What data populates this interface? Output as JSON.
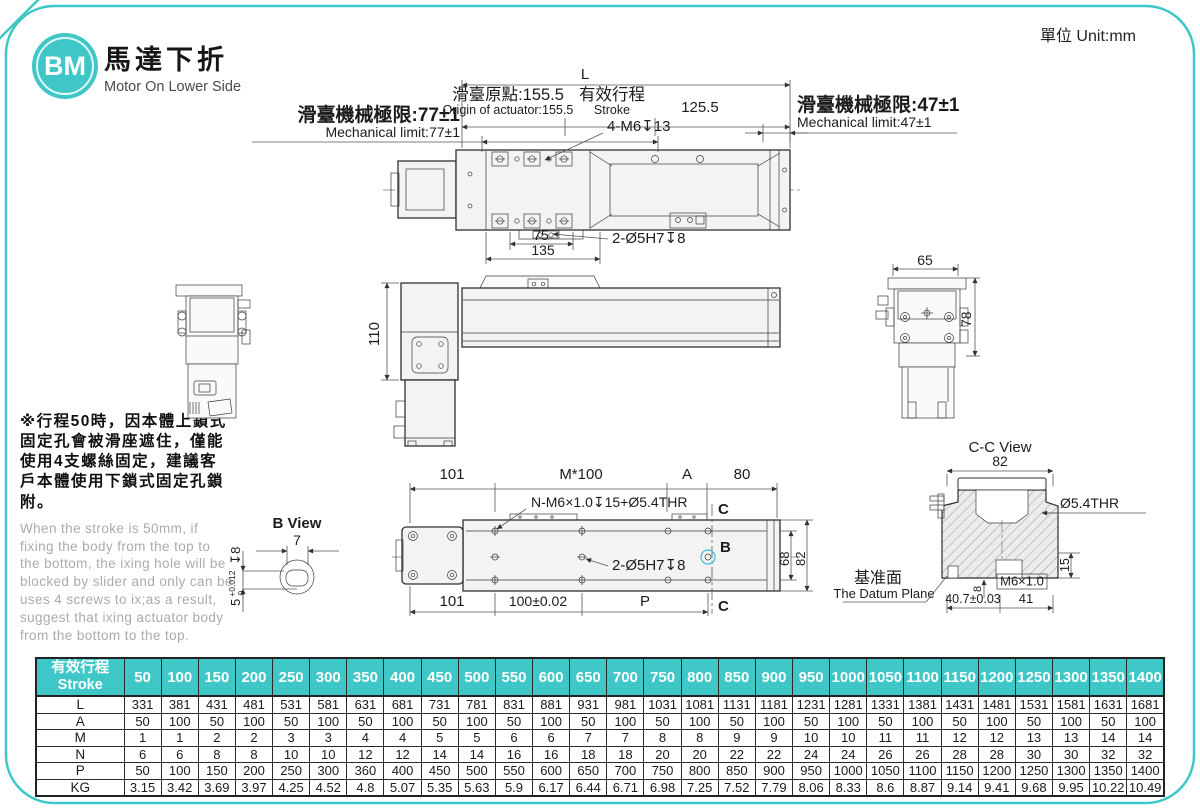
{
  "page": {
    "unit": "單位 Unit:mm"
  },
  "colors": {
    "teal": "#3fc7c7",
    "orange": "#f0a132",
    "cyan": "#3fbdd8",
    "gray_text": "#a8a8a8"
  },
  "header": {
    "logo": "BM",
    "title_zh": "馬達下折",
    "title_en": "Motor On Lower Side"
  },
  "note": {
    "zh": "※行程50時，因本體上鎖式固定孔會被滑座遮住，僅能使用4支螺絲固定，建議客戶本體使用下鎖式固定孔鎖附。",
    "en": "When the stroke is 50mm, if fixing the body from the top to the bottom, the ixing hole will be blocked by slider and only can be uses 4 screws to ix;as a result, suggest that ixing actuator body from the bottom to the top."
  },
  "drawing": {
    "top": {
      "l": "L",
      "origin_zh": "滑臺原點:155.5",
      "origin_en": "Origin of actuator:155.5",
      "stroke_zh": "有效行程",
      "stroke_en": "Stroke",
      "d125": "125.5",
      "lim77_zh": "滑臺機械極限:77±1",
      "lim77_en": "Mechanical limit:77±1",
      "lim47_zh": "滑臺機械極限:47±1",
      "lim47_en": "Mechanical limit:47±1",
      "m6": "4-M6↧13",
      "d75": "75",
      "d135": "135",
      "pin": "2-Ø5H7↧8"
    },
    "side": {
      "d110": "110"
    },
    "right": {
      "d65": "65",
      "d78": "78"
    },
    "bottom": {
      "d101a": "101",
      "m100": "M*100",
      "a": "A",
      "d80": "80",
      "nm6": "N-M6×1.0↧15+Ø5.4THR",
      "pin": "2-Ø5H7↧8",
      "d101b": "101",
      "d100": "100±0.02",
      "p": "P",
      "c": "C",
      "b": "B",
      "d68": "68",
      "d82": "82"
    },
    "bview": {
      "title": "B View",
      "d7": "7",
      "tol_nom": "5",
      "tol_hi": "+0.012",
      "tol_lo": "0",
      "depth": "↧8"
    },
    "ccview": {
      "title": "C-C View",
      "d82": "82",
      "thr": "Ø5.4THR",
      "d15": "15",
      "m6": "M6×1.0",
      "d8": "8",
      "d407": "40.7±0.03",
      "d41": "41",
      "datum_zh": "基准面",
      "datum_en": "The Datum Plane"
    }
  },
  "table": {
    "header_zh": "有效行程",
    "header_en": "Stroke",
    "strokes": [
      "50",
      "100",
      "150",
      "200",
      "250",
      "300",
      "350",
      "400",
      "450",
      "500",
      "550",
      "600",
      "650",
      "700",
      "750",
      "800",
      "850",
      "900",
      "950",
      "1000",
      "1050",
      "1100",
      "1150",
      "1200",
      "1250",
      "1300",
      "1350",
      "1400"
    ],
    "rows": [
      {
        "label": "L",
        "values": [
          "331",
          "381",
          "431",
          "481",
          "531",
          "581",
          "631",
          "681",
          "731",
          "781",
          "831",
          "881",
          "931",
          "981",
          "1031",
          "1081",
          "1131",
          "1181",
          "1231",
          "1281",
          "1331",
          "1381",
          "1431",
          "1481",
          "1531",
          "1581",
          "1631",
          "1681"
        ]
      },
      {
        "label": "A",
        "values": [
          "50",
          "100",
          "50",
          "100",
          "50",
          "100",
          "50",
          "100",
          "50",
          "100",
          "50",
          "100",
          "50",
          "100",
          "50",
          "100",
          "50",
          "100",
          "50",
          "100",
          "50",
          "100",
          "50",
          "100",
          "50",
          "100",
          "50",
          "100"
        ]
      },
      {
        "label": "M",
        "values": [
          "1",
          "1",
          "2",
          "2",
          "3",
          "3",
          "4",
          "4",
          "5",
          "5",
          "6",
          "6",
          "7",
          "7",
          "8",
          "8",
          "9",
          "9",
          "10",
          "10",
          "11",
          "11",
          "12",
          "12",
          "13",
          "13",
          "14",
          "14"
        ]
      },
      {
        "label": "N",
        "values": [
          "6",
          "6",
          "8",
          "8",
          "10",
          "10",
          "12",
          "12",
          "14",
          "14",
          "16",
          "16",
          "18",
          "18",
          "20",
          "20",
          "22",
          "22",
          "24",
          "24",
          "26",
          "26",
          "28",
          "28",
          "30",
          "30",
          "32",
          "32"
        ]
      },
      {
        "label": "P",
        "values": [
          "50",
          "100",
          "150",
          "200",
          "250",
          "300",
          "360",
          "400",
          "450",
          "500",
          "550",
          "600",
          "650",
          "700",
          "750",
          "800",
          "850",
          "900",
          "950",
          "1000",
          "1050",
          "1100",
          "1150",
          "1200",
          "1250",
          "1300",
          "1350",
          "1400"
        ]
      },
      {
        "label": "KG",
        "values": [
          "3.15",
          "3.42",
          "3.69",
          "3.97",
          "4.25",
          "4.52",
          "4.8",
          "5.07",
          "5.35",
          "5.63",
          "5.9",
          "6.17",
          "6.44",
          "6.71",
          "6.98",
          "7.25",
          "7.52",
          "7.79",
          "8.06",
          "8.33",
          "8.6",
          "8.87",
          "9.14",
          "9.41",
          "9.68",
          "9.95",
          "10.22",
          "10.49"
        ]
      }
    ]
  }
}
